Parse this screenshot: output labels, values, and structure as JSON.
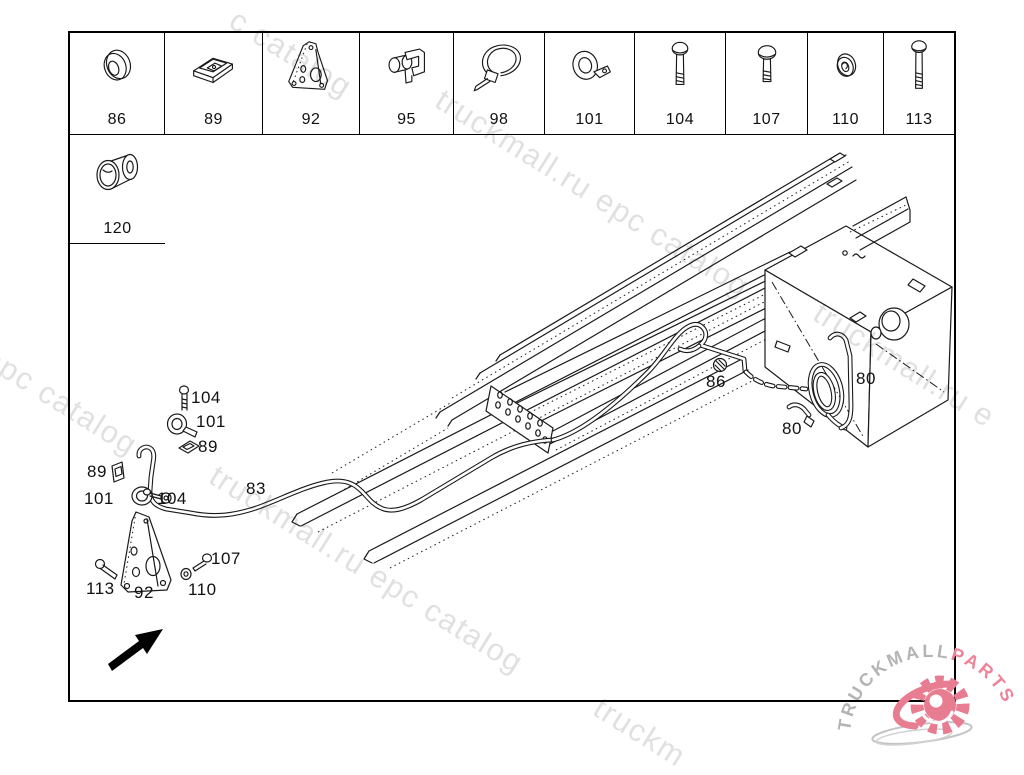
{
  "strip": {
    "row1": [
      {
        "num": "86",
        "part": "grommet"
      },
      {
        "num": "89",
        "part": "clip-nut"
      },
      {
        "num": "92",
        "part": "bracket-plate"
      },
      {
        "num": "95",
        "part": "pipe-clip"
      },
      {
        "num": "98",
        "part": "cable-tie"
      },
      {
        "num": "101",
        "part": "p-clamp"
      },
      {
        "num": "104",
        "part": "hex-bolt"
      },
      {
        "num": "107",
        "part": "hex-bolt-short"
      },
      {
        "num": "110",
        "part": "washer"
      },
      {
        "num": "113",
        "part": "hex-bolt-long"
      }
    ],
    "row2": [
      {
        "num": "120",
        "part": "spacer-sleeve"
      }
    ]
  },
  "diagram": {
    "callouts": [
      {
        "label": "104"
      },
      {
        "label": "101"
      },
      {
        "label": "89"
      },
      {
        "label": "89"
      },
      {
        "label": "101"
      },
      {
        "label": "104"
      },
      {
        "label": "83"
      },
      {
        "label": "86"
      },
      {
        "label": "80"
      },
      {
        "label": "80"
      },
      {
        "label": "107"
      },
      {
        "label": "110"
      },
      {
        "label": "113"
      },
      {
        "label": "92"
      }
    ]
  },
  "watermarks": [
    {
      "text": "c catalog"
    },
    {
      "text": "truckmall.ru epc catalog"
    },
    {
      "text": "l epc catalog"
    },
    {
      "text": "truckmall.ru epc catalog"
    },
    {
      "text": "truckmall.ru e"
    },
    {
      "text": "truckm"
    }
  ],
  "logo": {
    "name": "TRUCKMALL",
    "suffix": "PARTS"
  },
  "colors": {
    "line": "#1a1a1a",
    "frame_border": "#000000",
    "watermark_gray": "rgba(0,0,0,0.12)",
    "logo_gray": "#b4b4b4",
    "logo_pink": "#e87d92"
  }
}
